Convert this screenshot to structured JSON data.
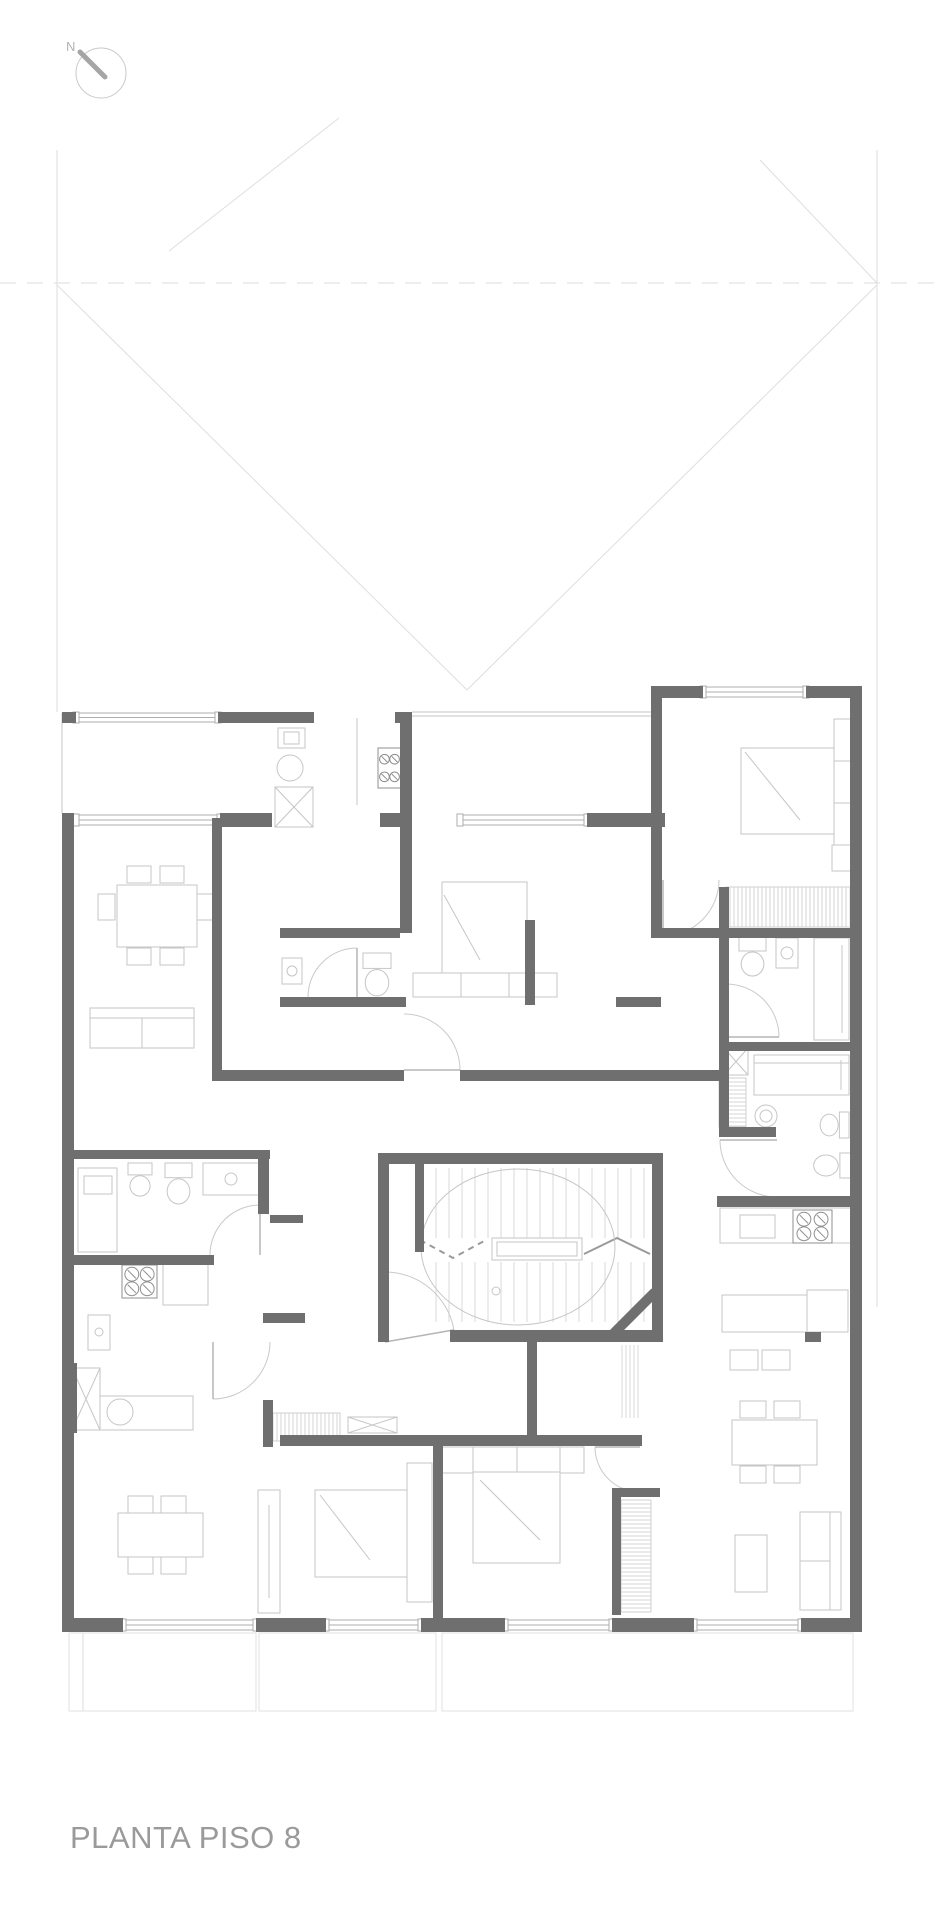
{
  "title": {
    "label": "PLANTA PISO 8"
  },
  "north": {
    "label": "N"
  },
  "palette": {
    "wall": "#6f6f6f",
    "window_stroke": "#adadad",
    "furniture": "#c6c6c6",
    "faint": "#dedede",
    "hatch": "#d4d4d4",
    "arc": "#c9c9c9",
    "stove": "#8f8f8f",
    "tread": "#d9d9d9",
    "compass_circle": "#c9c9c9",
    "compass_needle": "#a5a5a5",
    "title_color": "#9a9a9a"
  },
  "drawing": {
    "walls": [
      [
        62,
        712,
        14,
        11
      ],
      [
        218,
        712,
        96,
        11
      ],
      [
        395,
        712,
        17,
        11
      ],
      [
        651,
        686,
        52,
        12
      ],
      [
        806,
        686,
        56,
        12
      ],
      [
        850,
        686,
        12,
        946
      ],
      [
        62,
        813,
        12,
        819
      ],
      [
        69,
        1618,
        54,
        14
      ],
      [
        256,
        1618,
        70,
        14
      ],
      [
        421,
        1618,
        84,
        14
      ],
      [
        612,
        1618,
        82,
        14
      ],
      [
        801,
        1618,
        61,
        14
      ],
      [
        220,
        813,
        52,
        14
      ],
      [
        380,
        813,
        32,
        14
      ],
      [
        587,
        813,
        78,
        14
      ],
      [
        212,
        818,
        10,
        252
      ],
      [
        400,
        712,
        12,
        221
      ],
      [
        651,
        698,
        11,
        240
      ],
      [
        280,
        928,
        120,
        10
      ],
      [
        280,
        997,
        126,
        10
      ],
      [
        616,
        997,
        45,
        10
      ],
      [
        651,
        928,
        209,
        10
      ],
      [
        525,
        920,
        10,
        85
      ],
      [
        719,
        887,
        10,
        248
      ],
      [
        726,
        1042,
        134,
        9
      ],
      [
        719,
        1127,
        57,
        10
      ],
      [
        717,
        1196,
        143,
        11
      ],
      [
        212,
        1070,
        192,
        11
      ],
      [
        460,
        1070,
        262,
        11
      ],
      [
        67,
        1150,
        203,
        9
      ],
      [
        258,
        1150,
        11,
        64
      ],
      [
        67,
        1255,
        147,
        10
      ],
      [
        263,
        1313,
        42,
        10
      ],
      [
        67,
        1363,
        10,
        70
      ],
      [
        263,
        1400,
        10,
        47
      ],
      [
        378,
        1153,
        285,
        11
      ],
      [
        378,
        1164,
        11,
        178
      ],
      [
        652,
        1164,
        11,
        178
      ],
      [
        415,
        1164,
        9,
        88
      ],
      [
        450,
        1330,
        213,
        12
      ],
      [
        527,
        1342,
        10,
        96
      ],
      [
        280,
        1435,
        362,
        11
      ],
      [
        433,
        1446,
        10,
        172
      ],
      [
        612,
        1488,
        48,
        9
      ],
      [
        612,
        1493,
        9,
        122
      ],
      [
        805,
        1332,
        16,
        10
      ],
      [
        270,
        1215,
        33,
        8
      ]
    ],
    "diag_walls": [
      [
        613,
        1334,
        655,
        1292,
        10
      ]
    ],
    "windows": [
      [
        76,
        713,
        142,
        9
      ],
      [
        703,
        687,
        103,
        10
      ],
      [
        76,
        815,
        144,
        10
      ],
      [
        460,
        815,
        127,
        10
      ],
      [
        123,
        1620,
        133,
        10
      ],
      [
        326,
        1620,
        95,
        10
      ],
      [
        505,
        1620,
        107,
        10
      ],
      [
        694,
        1620,
        107,
        10
      ]
    ],
    "door_arcs": [
      [
        404,
        1070,
        56,
        270,
        360
      ],
      [
        357,
        997,
        49,
        180,
        270
      ],
      [
        260,
        1255,
        50,
        180,
        270
      ],
      [
        213,
        1342,
        57,
        0,
        90
      ],
      [
        663,
        880,
        56,
        0,
        90
      ],
      [
        726,
        1037,
        53,
        270,
        360
      ],
      [
        777,
        1140,
        57,
        90,
        180
      ],
      [
        640,
        1447,
        45,
        90,
        180
      ],
      [
        385,
        1342,
        70,
        270,
        350
      ]
    ],
    "stoves": [
      [
        378,
        748,
        23,
        40
      ],
      [
        793,
        1210,
        39,
        33
      ],
      [
        122,
        1265,
        35,
        33
      ]
    ],
    "toilets": [
      [
        363,
        953,
        28,
        44,
        "up"
      ],
      [
        739,
        937,
        27,
        40,
        "up"
      ],
      [
        819,
        1112,
        30,
        26,
        "right"
      ],
      [
        812,
        1153,
        41,
        25,
        "right"
      ],
      [
        128,
        1163,
        24,
        34,
        "up"
      ],
      [
        165,
        1163,
        27,
        42,
        "up"
      ]
    ],
    "x_boxes": [
      [
        275,
        787,
        38,
        40
      ],
      [
        724,
        1048,
        24,
        27
      ],
      [
        72,
        1368,
        28,
        62
      ],
      [
        348,
        1417,
        49,
        16
      ]
    ],
    "hatches": [
      [
        726,
        887,
        127,
        40,
        "v"
      ],
      [
        719,
        1078,
        27,
        49,
        "h"
      ],
      [
        273,
        1413,
        67,
        28,
        "v"
      ],
      [
        621,
        1500,
        30,
        112,
        "h"
      ]
    ],
    "circles": [
      [
        292,
        971,
        5
      ],
      [
        787,
        953,
        6
      ],
      [
        766,
        1116,
        11
      ],
      [
        766,
        1116,
        6
      ],
      [
        231,
        1179,
        6
      ],
      [
        99,
        1332,
        4
      ],
      [
        120,
        1412,
        13
      ],
      [
        496,
        1291,
        4
      ],
      [
        290,
        768,
        13
      ]
    ],
    "ellipses": [
      [
        518,
        1247,
        97,
        78
      ]
    ],
    "light_rects": [
      [
        117,
        885,
        80,
        62
      ],
      [
        127,
        866,
        24,
        17
      ],
      [
        160,
        866,
        24,
        17
      ],
      [
        127,
        948,
        24,
        17
      ],
      [
        160,
        948,
        24,
        17
      ],
      [
        98,
        894,
        17,
        26
      ],
      [
        197,
        894,
        17,
        26
      ],
      [
        90,
        1008,
        104,
        40
      ],
      [
        278,
        728,
        27,
        20
      ],
      [
        284,
        732,
        15,
        12
      ],
      [
        442,
        882,
        85,
        91
      ],
      [
        413,
        973,
        144,
        24
      ],
      [
        282,
        958,
        20,
        26
      ],
      [
        741,
        748,
        93,
        86
      ],
      [
        834,
        719,
        25,
        142
      ],
      [
        832,
        845,
        25,
        26
      ],
      [
        776,
        938,
        22,
        30
      ],
      [
        814,
        938,
        35,
        102
      ],
      [
        754,
        1055,
        95,
        40
      ],
      [
        720,
        1208,
        137,
        35
      ],
      [
        740,
        1215,
        35,
        23
      ],
      [
        722,
        1295,
        85,
        37
      ],
      [
        807,
        1290,
        41,
        42
      ],
      [
        730,
        1350,
        28,
        20
      ],
      [
        762,
        1350,
        28,
        20
      ],
      [
        732,
        1420,
        85,
        45
      ],
      [
        740,
        1401,
        26,
        17
      ],
      [
        774,
        1401,
        26,
        17
      ],
      [
        740,
        1466,
        26,
        17
      ],
      [
        774,
        1466,
        26,
        17
      ],
      [
        800,
        1512,
        41,
        98
      ],
      [
        735,
        1535,
        32,
        57
      ],
      [
        78,
        1168,
        39,
        84
      ],
      [
        84,
        1176,
        28,
        18
      ],
      [
        203,
        1163,
        57,
        32
      ],
      [
        163,
        1263,
        45,
        42
      ],
      [
        88,
        1315,
        22,
        35
      ],
      [
        88,
        1396,
        105,
        34
      ],
      [
        118,
        1513,
        85,
        44
      ],
      [
        128,
        1496,
        25,
        17
      ],
      [
        161,
        1496,
        25,
        17
      ],
      [
        128,
        1557,
        25,
        17
      ],
      [
        161,
        1557,
        25,
        17
      ],
      [
        258,
        1490,
        22,
        123
      ],
      [
        315,
        1490,
        92,
        87
      ],
      [
        407,
        1463,
        25,
        139
      ],
      [
        473,
        1447,
        87,
        116
      ],
      [
        473,
        1447,
        87,
        25
      ],
      [
        440,
        1447,
        33,
        26
      ],
      [
        560,
        1447,
        24,
        26
      ],
      [
        492,
        1238,
        90,
        22
      ],
      [
        497,
        1242,
        80,
        14
      ]
    ],
    "light_lines": [
      [
        90,
        1018,
        194,
        1018
      ],
      [
        142,
        1018,
        142,
        1048
      ],
      [
        461,
        973,
        461,
        997
      ],
      [
        509,
        973,
        509,
        997
      ],
      [
        444,
        895,
        480,
        960
      ],
      [
        834,
        761,
        859,
        761
      ],
      [
        834,
        803,
        859,
        803
      ],
      [
        745,
        752,
        800,
        820
      ],
      [
        842,
        945,
        842,
        1033
      ],
      [
        754,
        1063,
        849,
        1063
      ],
      [
        841,
        1060,
        841,
        1090
      ],
      [
        830,
        1512,
        830,
        1610
      ],
      [
        800,
        1561,
        830,
        1561
      ],
      [
        269,
        1505,
        269,
        1598
      ],
      [
        320,
        1495,
        370,
        1560
      ],
      [
        517,
        1447,
        517,
        1472
      ],
      [
        480,
        1480,
        540,
        1540
      ],
      [
        412,
        712,
        651,
        712
      ],
      [
        412,
        716,
        651,
        716
      ],
      [
        62,
        713,
        62,
        813
      ],
      [
        357,
        718,
        357,
        805
      ]
    ],
    "faint_lines": [
      [
        57,
        150,
        57,
        712
      ],
      [
        877,
        150,
        877,
        1307
      ],
      [
        57,
        285,
        467,
        690
      ],
      [
        877,
        285,
        467,
        690
      ],
      [
        169,
        251,
        339,
        118
      ],
      [
        760,
        160,
        877,
        283
      ],
      [
        83,
        1633,
        83,
        1711
      ]
    ],
    "faint_dashed": [
      [
        0,
        283,
        936,
        283
      ]
    ],
    "faint_rects": [
      [
        69,
        1633,
        187,
        78
      ],
      [
        259,
        1633,
        177,
        78
      ],
      [
        442,
        1633,
        411,
        78
      ]
    ],
    "tread_runs": [
      {
        "x0": 436,
        "x1": 644,
        "step": 13,
        "y0": 1168,
        "y1": 1238
      },
      {
        "x0": 436,
        "x1": 644,
        "step": 13,
        "y0": 1262,
        "y1": 1322
      },
      {
        "x0": 622,
        "x1": 638,
        "step": 4,
        "y0": 1345,
        "y1": 1418
      }
    ],
    "zigzag_solid": [
      [
        584,
        1254
      ],
      [
        617,
        1238
      ],
      [
        650,
        1254
      ]
    ],
    "zigzag_dashed": [
      [
        420,
        1240
      ],
      [
        453,
        1258
      ],
      [
        486,
        1240
      ]
    ]
  }
}
